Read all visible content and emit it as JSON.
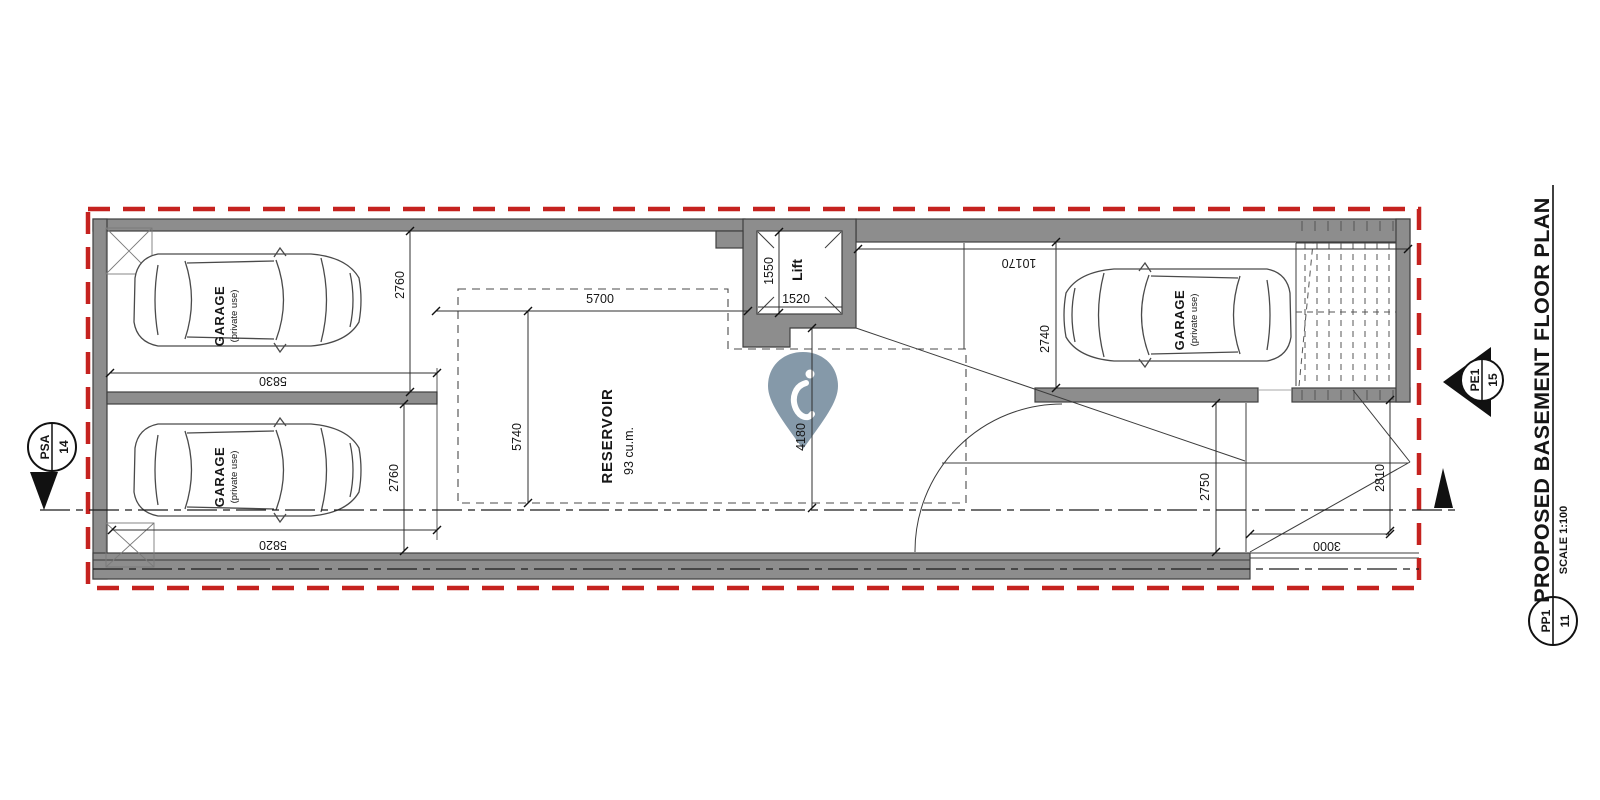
{
  "colors": {
    "boundary_red": "#c5221f",
    "wall_gray": "#8d8d8d",
    "pin_blue_gray": "#7e94a4"
  },
  "title_block": {
    "title": "PROPOSED BASEMENT FLOOR PLAN",
    "scale": "SCALE 1:100"
  },
  "markers": {
    "section_left": {
      "code": "PSA",
      "number": "14"
    },
    "section_right": {
      "code": "PE1",
      "number": "15"
    },
    "plan_ref": {
      "code": "PP1",
      "number": "11"
    }
  },
  "rooms": {
    "garage_top_left": {
      "name": "GARAGE",
      "sub": "(private use)"
    },
    "garage_bottom_left": {
      "name": "GARAGE",
      "sub": "(private use)"
    },
    "garage_right": {
      "name": "GARAGE",
      "sub": "(private use)"
    },
    "reservoir": {
      "name": "RESERVOIR",
      "volume": "93 cu.m."
    },
    "lift": {
      "name": "Lift"
    }
  },
  "dimensions": {
    "garage_tl_depth": "2760",
    "garage_tl_width": "5830",
    "garage_bl_depth": "2760",
    "garage_bl_width": "5820",
    "reservoir_width": "5700",
    "reservoir_depth": "5740",
    "lift_depth": "1550",
    "lift_width": "1520",
    "lobby_depth": "4180",
    "right_side_width": "10170",
    "garage_r_depth": "2740",
    "ramp_inner_depth": "2750",
    "ramp_outer_depth": "2810",
    "ramp_width": "3000"
  }
}
